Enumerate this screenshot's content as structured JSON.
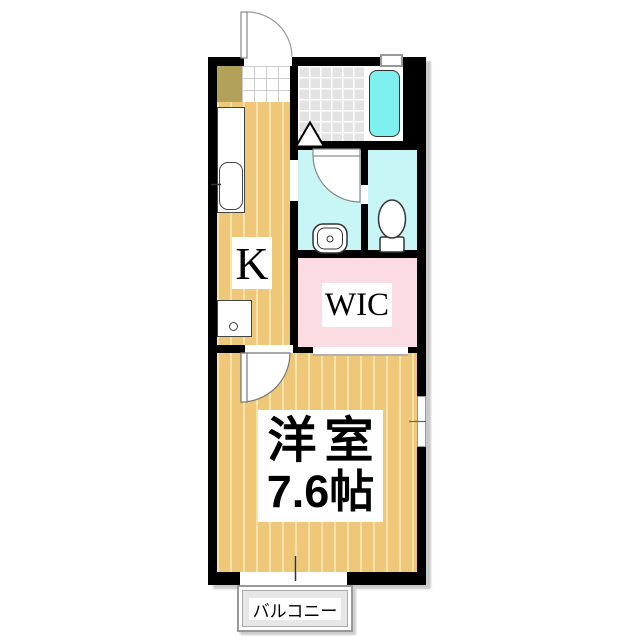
{
  "rooms": {
    "kitchen": {
      "label": "K"
    },
    "walk_in_closet": {
      "label": "WIC"
    },
    "western_room": {
      "label_line1": "洋室",
      "label_line2": "7.6帖"
    },
    "balcony": {
      "label": "バルコニー"
    }
  },
  "fixtures": [
    "entrance-door",
    "shoe-cabinet",
    "genkan-tile",
    "kitchen-counter",
    "kitchen-sink",
    "washing-machine-pan",
    "bathroom-tile-floor",
    "bathtub",
    "bath-folding-door",
    "washroom-door",
    "wash-basin",
    "toilet",
    "walk-in-closet-opening",
    "room-door",
    "bathroom-window",
    "room-window",
    "balcony-sliding-door"
  ],
  "colors": {
    "wall": "#000000",
    "wood_floor": "#eec878",
    "wood_floor_stripe": "#f6e3ab",
    "bathroom_tile": "#e3e3e3",
    "bathtub": "#7ef0ef",
    "wet_area_cyan": "#c8f6f6",
    "wic_pink": "#fbdce2",
    "shoe_cabinet_olive": "#b1a159",
    "balcony_floor": "#e7e7e7",
    "genkan_tile": "#ffffff"
  }
}
